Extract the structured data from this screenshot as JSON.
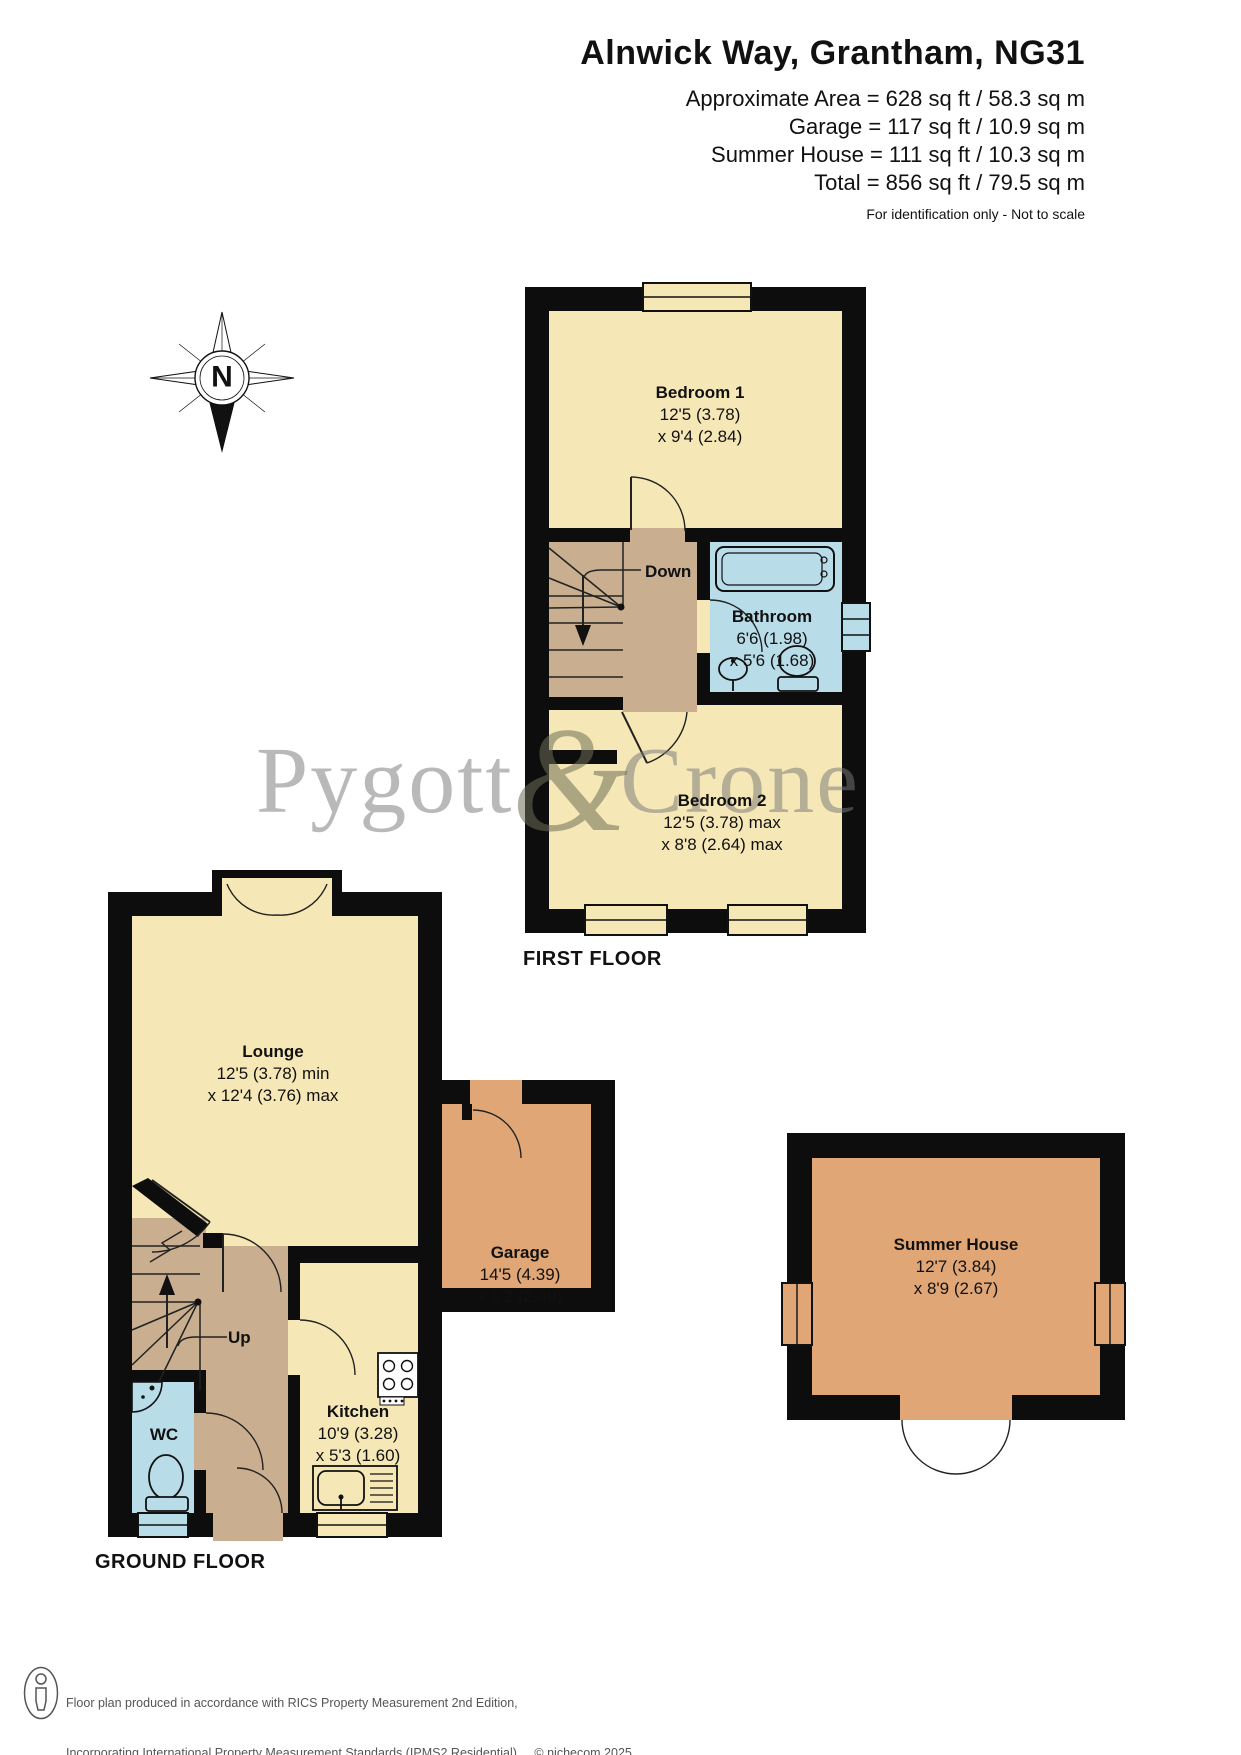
{
  "header": {
    "title": "Alnwick Way, Grantham, NG31",
    "area_lines": [
      "Approximate Area = 628 sq ft / 58.3 sq m",
      "Garage = 117 sq ft / 10.9 sq m",
      "Summer House = 111 sq ft / 10.3 sq m",
      "Total = 856 sq ft / 79.5 sq m"
    ],
    "disclaimer": "For identification only - Not to scale"
  },
  "compass": {
    "north_label": "N"
  },
  "first_floor": {
    "label": "FIRST FLOOR",
    "stairs_label": "Down",
    "bedroom1": {
      "name": "Bedroom 1",
      "dim1": "12'5 (3.78)",
      "dim2": "x 9'4 (2.84)"
    },
    "bathroom": {
      "name": "Bathroom",
      "dim1": "6'6 (1.98)",
      "dim2": "x 5'6 (1.68)"
    },
    "bedroom2": {
      "name": "Bedroom 2",
      "dim1": "12'5 (3.78) max",
      "dim2": "x 8'8 (2.64) max"
    }
  },
  "ground_floor": {
    "label": "GROUND FLOOR",
    "stairs_label": "Up",
    "lounge": {
      "name": "Lounge",
      "dim1": "12'5 (3.78) min",
      "dim2": "x 12'4 (3.76) max"
    },
    "wc": {
      "name": "WC"
    },
    "kitchen": {
      "name": "Kitchen",
      "dim1": "10'9 (3.28)",
      "dim2": "x 5'3 (1.60)"
    }
  },
  "garage": {
    "name": "Garage",
    "dim1": "14'5 (4.39)",
    "dim2": "x 8'2 (2.49)"
  },
  "summer_house": {
    "name": "Summer House",
    "dim1": "12'7 (3.84)",
    "dim2": "x 8'9 (2.67)"
  },
  "watermark": {
    "part1": "Pygott",
    "amp": "&",
    "part2": "Crone"
  },
  "footer": {
    "line1": "Floor plan produced in accordance with RICS Property Measurement 2nd Edition,",
    "line2": "Incorporating International Property Measurement Standards (IPMS2 Residential).",
    "copyright": "© nichecom 2025.",
    "line3": "Produced for Pygott & Crone.",
    "ref": "REF:  1347500"
  },
  "colors": {
    "room_cream": "#f6e8b6",
    "hall_tan": "#c9ae90",
    "bath_blue": "#b9dce9",
    "garage_orange": "#e0a676",
    "wall_black": "#0d0d0d",
    "watermark_gray": "#9a9a9a"
  }
}
